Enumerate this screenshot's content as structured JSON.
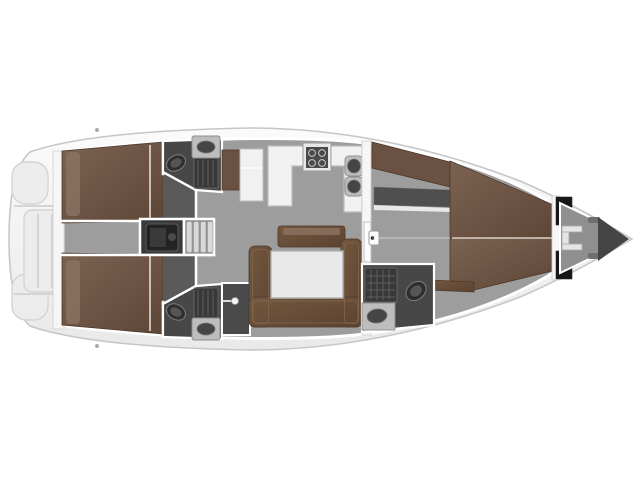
{
  "plan": {
    "kind": "sailing-yacht-interior-layout-top-view",
    "orientation": "bow-right-stern-left",
    "regions": [
      "transom-platform",
      "aft-cabin-port",
      "aft-cabin-starboard",
      "head-aft-port",
      "head-aft-starboard",
      "shower-stall-starboard",
      "engine-room",
      "companionway-steps",
      "wardrobe-port",
      "storage-cabinet",
      "galley",
      "salon-settee",
      "salon-table",
      "sideboard",
      "forward-bulkhead-door",
      "owners-cabin",
      "owners-sofa",
      "vanity-desk",
      "v-berth",
      "head-forward",
      "fore-peak-anchor-locker",
      "windlass"
    ]
  },
  "colors": {
    "background": "#ffffff",
    "hull-fill-top": "#fbfbfb",
    "hull-fill-bottom": "#e9e9e9",
    "hull-stroke": "#c6c6c6",
    "floor": "#9d9d9d",
    "floor-cabin": "#5a5a5a",
    "floor-head": "#474747",
    "wall": "#f6f6f6",
    "wall-line": "#ffffff",
    "wall-stroke": "#d0d0d0",
    "berth-light": "#7c6251",
    "berth-dark": "#5e4637",
    "settee-light": "#74583f",
    "settee-dark": "#5c4331",
    "wardrobe": "#6b5142",
    "table": "#e9e9e9",
    "counter": "#f1f1f1",
    "counter-stroke": "#bdbdbd",
    "engine-room": "#3a3a3a",
    "engine": "#232323",
    "steps-bg": "#8f8f8f",
    "step": "#d9d9d9",
    "fixture-dark": "#2e2e2e",
    "fixture-mid": "#555555",
    "grate": "#383838",
    "grate-line": "#5e5e5e",
    "sink-basin": "#454545",
    "sink-counter": "#bdbdbd",
    "stall": "#4a4a4a",
    "locker-panel": "#161616",
    "bow-tip": "#454545",
    "transom": "#ececec",
    "transom-line": "#d4d4d4",
    "desk": "#4f4f4f",
    "cleat": "#a9a9a9"
  }
}
